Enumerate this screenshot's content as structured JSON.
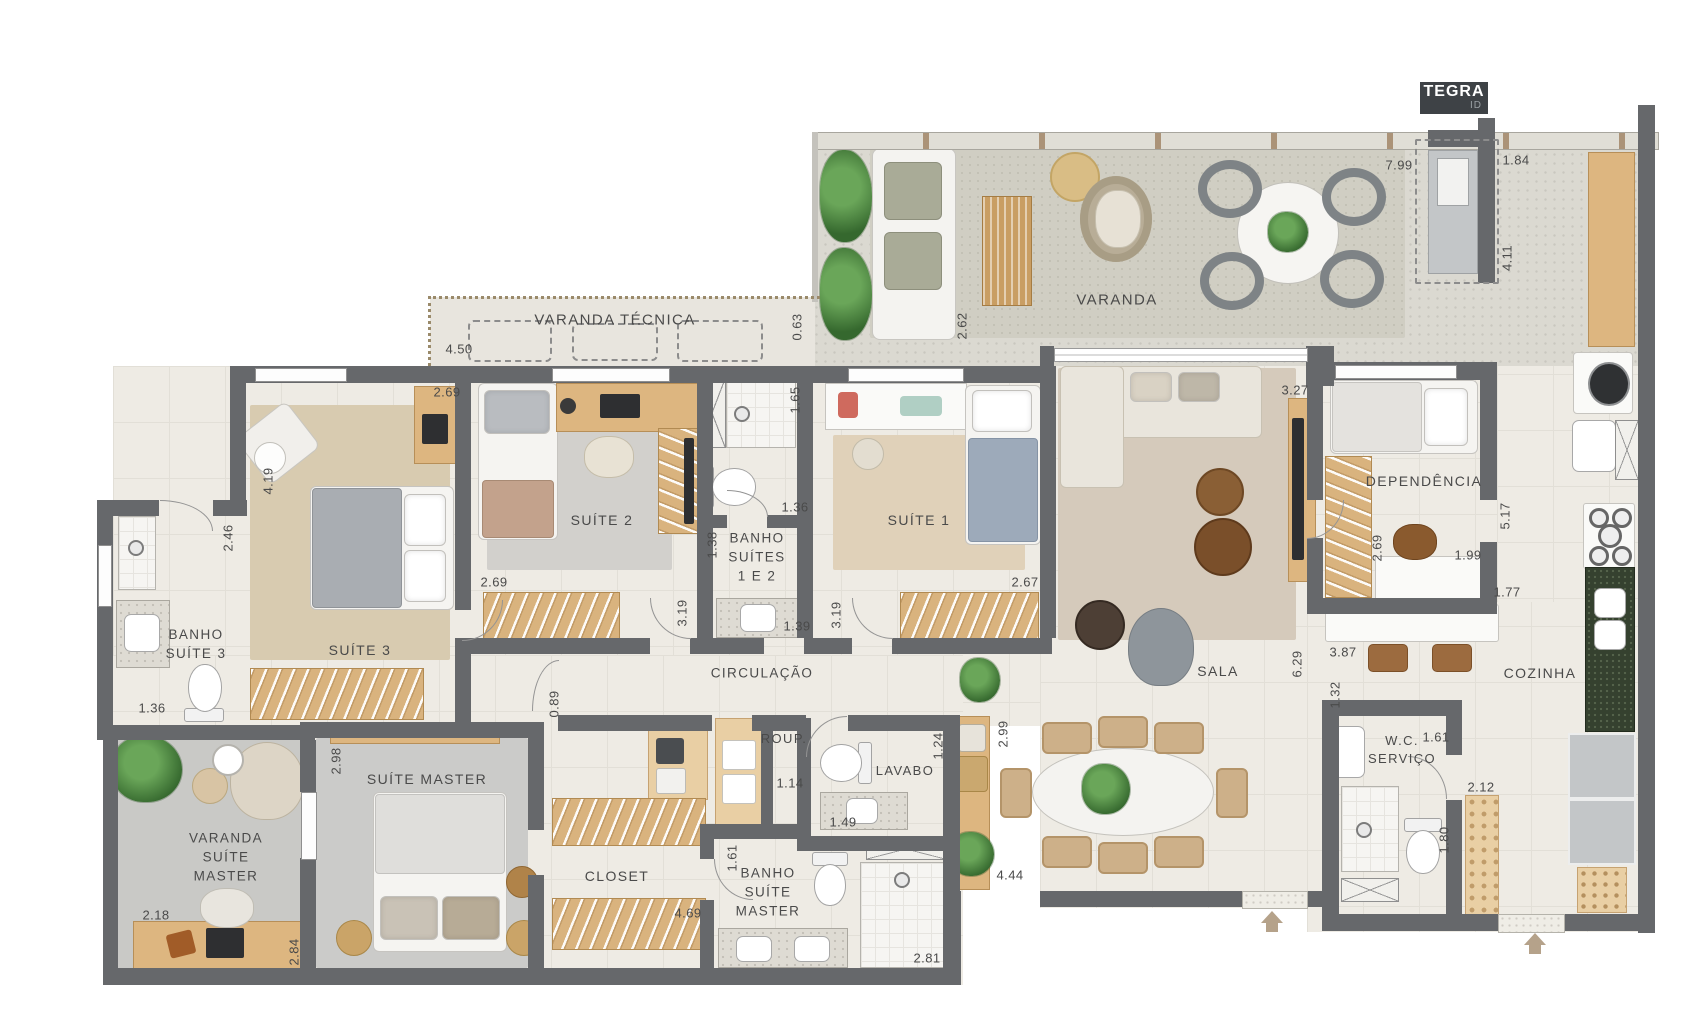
{
  "logo": {
    "brand": "TEGRA",
    "sub": "ID"
  },
  "palette": {
    "wall": "#66686b",
    "floor": "#eeebe4",
    "deck": "#dbd9d1",
    "wood": "#ddb680",
    "granite": "#35412f",
    "label": "#4a4a4a",
    "arrow": "#b5a28a"
  },
  "rooms": [
    {
      "id": "varanda-tecnica",
      "label": "VARANDA TÉCNICA",
      "x": 615,
      "y": 320,
      "fs": 15
    },
    {
      "id": "varanda",
      "label": "VARANDA",
      "x": 1117,
      "y": 300,
      "fs": 15
    },
    {
      "id": "suite-3",
      "label": "SUÍTE 3",
      "x": 360,
      "y": 651,
      "fs": 14
    },
    {
      "id": "banho-suite-3",
      "label": "BANHO\nSUÍTE 3",
      "x": 196,
      "y": 645,
      "fs": 13.5
    },
    {
      "id": "suite-2",
      "label": "SUÍTE 2",
      "x": 602,
      "y": 521,
      "fs": 14
    },
    {
      "id": "banho-suites-1e2",
      "label": "BANHO\nSUÍTES\n1 E 2",
      "x": 757,
      "y": 558,
      "fs": 13.5
    },
    {
      "id": "suite-1",
      "label": "SUÍTE 1",
      "x": 919,
      "y": 521,
      "fs": 14
    },
    {
      "id": "sala",
      "label": "SALA",
      "x": 1218,
      "y": 672,
      "fs": 14
    },
    {
      "id": "dependencia",
      "label": "DEPENDÊNCIA",
      "x": 1424,
      "y": 482,
      "fs": 14
    },
    {
      "id": "cozinha",
      "label": "COZINHA",
      "x": 1540,
      "y": 674,
      "fs": 14
    },
    {
      "id": "circulacao",
      "label": "CIRCULAÇÃO",
      "x": 762,
      "y": 674,
      "fs": 13.5
    },
    {
      "id": "roup",
      "label": "ROUP.",
      "x": 784,
      "y": 739,
      "fs": 13
    },
    {
      "id": "lavabo",
      "label": "LAVABO",
      "x": 905,
      "y": 771,
      "fs": 13
    },
    {
      "id": "wc-servico",
      "label": "W.C.\nSERVIÇO",
      "x": 1402,
      "y": 750,
      "fs": 13
    },
    {
      "id": "closet",
      "label": "CLOSET",
      "x": 617,
      "y": 877,
      "fs": 14
    },
    {
      "id": "banho-suite-master",
      "label": "BANHO\nSUÍTE\nMASTER",
      "x": 768,
      "y": 893,
      "fs": 13.5
    },
    {
      "id": "suite-master",
      "label": "SUÍTE MASTER",
      "x": 427,
      "y": 780,
      "fs": 14
    },
    {
      "id": "varanda-suite-master",
      "label": "VARANDA\nSUÍTE\nMASTER",
      "x": 226,
      "y": 858,
      "fs": 13.5
    }
  ],
  "dimensions": [
    {
      "v": "7.99",
      "x": 1399,
      "y": 165
    },
    {
      "v": "1.84",
      "x": 1516,
      "y": 160
    },
    {
      "v": "4.11",
      "x": 1507,
      "y": 258,
      "r": 1
    },
    {
      "v": "0.63",
      "x": 797,
      "y": 327,
      "r": 1
    },
    {
      "v": "2.62",
      "x": 962,
      "y": 326,
      "r": 1
    },
    {
      "v": "4.50",
      "x": 459,
      "y": 349
    },
    {
      "v": "2.69",
      "x": 447,
      "y": 392
    },
    {
      "v": "4.19",
      "x": 268,
      "y": 481,
      "r": 1
    },
    {
      "v": "2.46",
      "x": 228,
      "y": 538,
      "r": 1
    },
    {
      "v": "1.36",
      "x": 152,
      "y": 708
    },
    {
      "v": "2.69",
      "x": 494,
      "y": 582
    },
    {
      "v": "1.65",
      "x": 795,
      "y": 400,
      "r": 1
    },
    {
      "v": "1.36",
      "x": 795,
      "y": 507
    },
    {
      "v": "1.38",
      "x": 712,
      "y": 545,
      "r": 1
    },
    {
      "v": "1.39",
      "x": 797,
      "y": 626
    },
    {
      "v": "3.19",
      "x": 682,
      "y": 613,
      "r": 1
    },
    {
      "v": "3.19",
      "x": 836,
      "y": 615,
      "r": 1
    },
    {
      "v": "2.67",
      "x": 1025,
      "y": 582
    },
    {
      "v": "3.27",
      "x": 1295,
      "y": 390
    },
    {
      "v": "2.69",
      "x": 1377,
      "y": 548,
      "r": 1
    },
    {
      "v": "1.99",
      "x": 1468,
      "y": 555
    },
    {
      "v": "5.17",
      "x": 1505,
      "y": 516,
      "r": 1
    },
    {
      "v": "1.77",
      "x": 1507,
      "y": 592
    },
    {
      "v": "6.29",
      "x": 1297,
      "y": 664,
      "r": 1
    },
    {
      "v": "3.87",
      "x": 1343,
      "y": 652
    },
    {
      "v": "1.32",
      "x": 1335,
      "y": 695,
      "r": 1
    },
    {
      "v": "2.99",
      "x": 1003,
      "y": 734,
      "r": 1
    },
    {
      "v": "4.44",
      "x": 1010,
      "y": 875
    },
    {
      "v": "1.24",
      "x": 938,
      "y": 746,
      "r": 1
    },
    {
      "v": "1.49",
      "x": 843,
      "y": 822
    },
    {
      "v": "1.14",
      "x": 790,
      "y": 783
    },
    {
      "v": "0.89",
      "x": 554,
      "y": 704,
      "r": 1
    },
    {
      "v": "2.98",
      "x": 336,
      "y": 761,
      "r": 1
    },
    {
      "v": "1.61",
      "x": 732,
      "y": 858,
      "r": 1
    },
    {
      "v": "4.69",
      "x": 688,
      "y": 913
    },
    {
      "v": "2.81",
      "x": 927,
      "y": 958
    },
    {
      "v": "1.61",
      "x": 1436,
      "y": 737
    },
    {
      "v": "1.80",
      "x": 1444,
      "y": 840,
      "r": 1
    },
    {
      "v": "2.12",
      "x": 1481,
      "y": 787
    },
    {
      "v": "2.18",
      "x": 156,
      "y": 915
    },
    {
      "v": "2.84",
      "x": 294,
      "y": 952,
      "r": 1
    }
  ],
  "arrows": [
    {
      "id": "social-entrance-arrow",
      "x": 1261,
      "y": 911
    },
    {
      "id": "service-entrance-arrow",
      "x": 1524,
      "y": 933
    }
  ]
}
